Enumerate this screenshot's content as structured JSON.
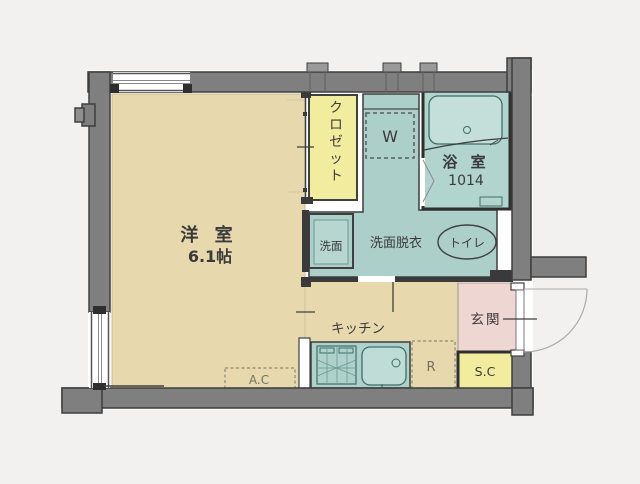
{
  "plan": {
    "type": "apartment-floor-plan",
    "rooms": {
      "western_room": {
        "label": "洋 室",
        "area": "6.1帖"
      },
      "closet": {
        "label": "クロゼット"
      },
      "bathroom": {
        "label": "浴 室",
        "size": "1014"
      },
      "washer_space": {
        "label": "W"
      },
      "washbasin": {
        "label": "洗面"
      },
      "washroom": {
        "label": "洗面脱衣"
      },
      "toilet": {
        "label": "トイレ"
      },
      "kitchen": {
        "label": "キッチン"
      },
      "entrance": {
        "label": "玄関"
      },
      "shoe_cabinet": {
        "label": "S.C"
      },
      "air_conditioner": {
        "label": "A.C"
      },
      "refrigerator": {
        "label": "R"
      }
    },
    "colors": {
      "wall": "#7f7f7f",
      "wall_outline": "#3f3f3f",
      "floor_beige": "#e7d9ad",
      "closet_yellow": "#f1ec9e",
      "wet_area_teal": "#adcfc9",
      "entrance_pink": "#eed6d3",
      "background": "#f2f1ef"
    }
  }
}
